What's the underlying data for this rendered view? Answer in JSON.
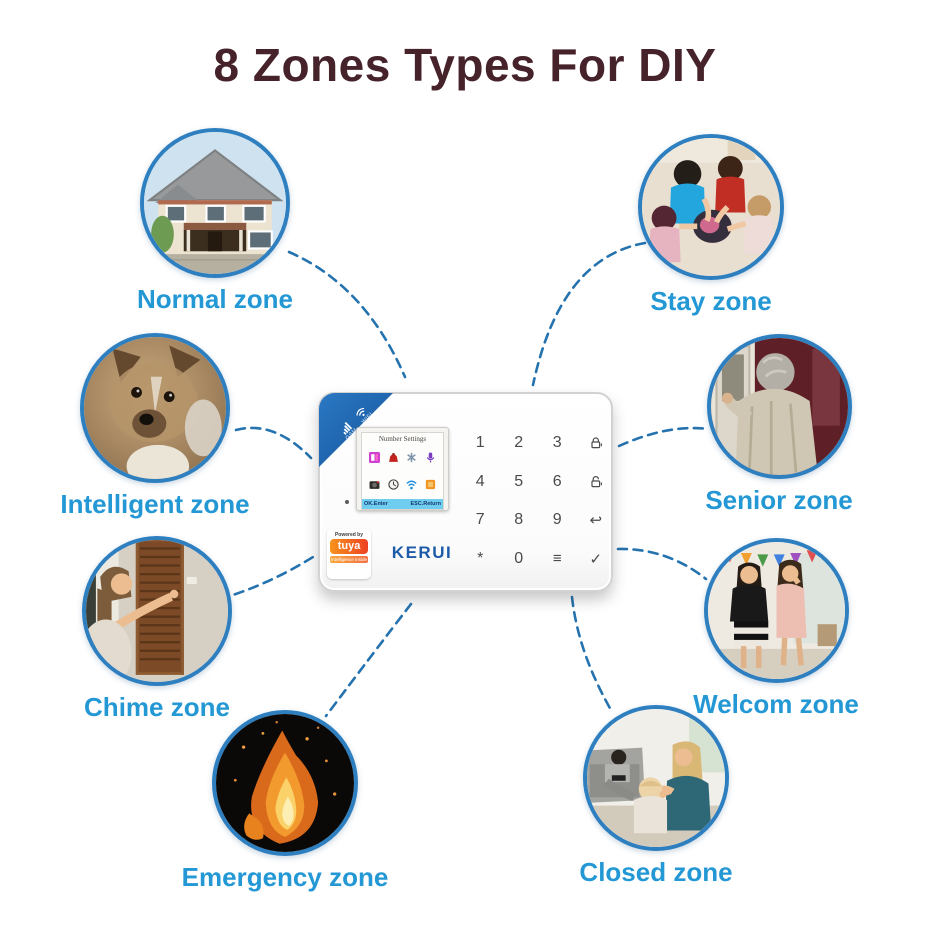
{
  "title": "8 Zones Types For DIY",
  "zones": [
    {
      "label": "Normal zone",
      "image": "house-exterior"
    },
    {
      "label": "Stay zone",
      "image": "children-playing"
    },
    {
      "label": "Intelligent zone",
      "image": "puppy"
    },
    {
      "label": "Senior zone",
      "image": "elderly-person-at-door"
    },
    {
      "label": "Chime zone",
      "image": "woman-pressing-doorbell"
    },
    {
      "label": "Welcom zone",
      "image": "women-at-party"
    },
    {
      "label": "Emergency zone",
      "image": "fire-flames"
    },
    {
      "label": "Closed zone",
      "image": "family-in-living-room"
    }
  ],
  "device": {
    "brand": "KERUI",
    "corner": {
      "gsm": "GSM",
      "wifi": "WIFI"
    },
    "screen": {
      "title": "Number Settings",
      "footer_left": "OK.Enter",
      "footer_right": "ESC.Return",
      "icons": [
        "phonebook-icon",
        "alarm-bag-icon",
        "fan-icon",
        "microphone-icon",
        "camera-icon",
        "clock-icon",
        "wifi-signal-icon",
        "storage-icon"
      ]
    },
    "keypad_rows": [
      {
        "keys": [
          "1",
          "2",
          "3"
        ],
        "icon": "arm-lock"
      },
      {
        "keys": [
          "4",
          "5",
          "6"
        ],
        "icon": "disarm-lock"
      },
      {
        "keys": [
          "7",
          "8",
          "9",
          "↩"
        ]
      },
      {
        "keys": [
          "*",
          "0",
          "≡",
          "✓"
        ]
      }
    ],
    "badge": {
      "powered_by": "Powered by",
      "name": "tuya",
      "sub": "Intelligence Inside"
    }
  },
  "colors": {
    "title": "#46232b",
    "zone_label": "#2498d5",
    "circle_border": "#2e7fc0",
    "connector": "#2472ae",
    "brand_blue": "#1d5aa8",
    "tuya_orange": "#ee4023",
    "corner_blue": "#1b5fa8",
    "lcd_bar_cyan": "#6fcdf0"
  }
}
